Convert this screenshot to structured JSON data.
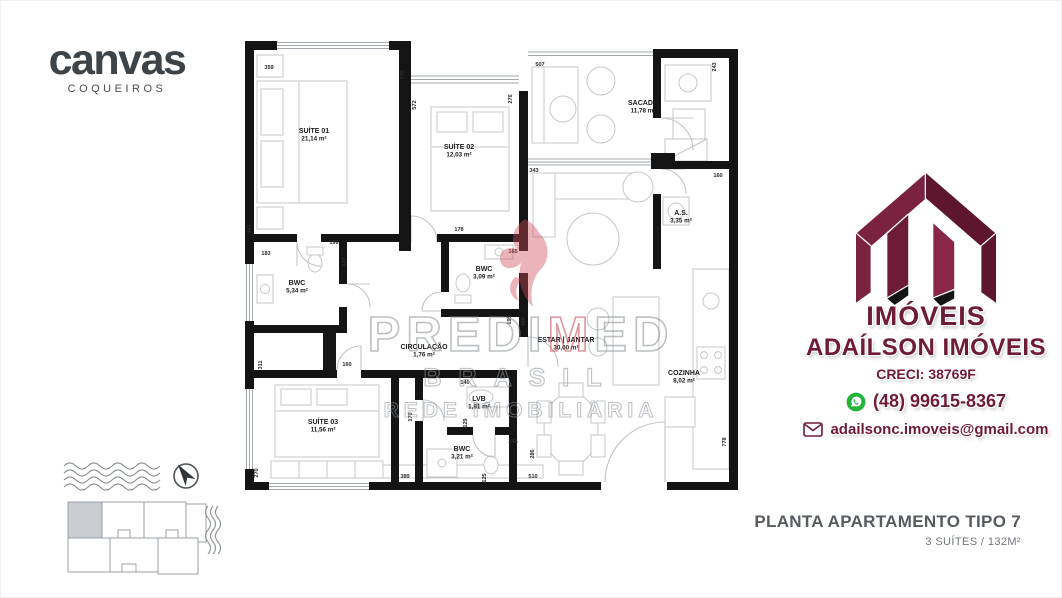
{
  "branding_left": {
    "logo": "canvas",
    "sublogo": "COQUEIROS"
  },
  "watermark": {
    "word": "PREDIMED",
    "accent_index": 5,
    "line2": "BRASIL",
    "line3": "REDE IMOBILIARIA"
  },
  "floorplan": {
    "rooms": [
      {
        "id": "suite-01",
        "name": "SUÍTE 01",
        "area": "21,14 m²",
        "x": 73,
        "y": 104
      },
      {
        "id": "suite-02",
        "name": "SUÍTE 02",
        "area": "12,03 m²",
        "x": 218,
        "y": 120
      },
      {
        "id": "sacada",
        "name": "SACADA",
        "area": "11,78 m²",
        "x": 402,
        "y": 76
      },
      {
        "id": "area-servico",
        "name": "A.S.",
        "area": "3,35 m²",
        "x": 440,
        "y": 186
      },
      {
        "id": "bwc-suite-01",
        "name": "BWC",
        "area": "5,34 m²",
        "x": 56,
        "y": 256
      },
      {
        "id": "bwc-suite-02",
        "name": "BWC",
        "area": "3,09 m²",
        "x": 243,
        "y": 242
      },
      {
        "id": "circulacao",
        "name": "CIRCULAÇÃO",
        "area": "1,76 m²",
        "x": 183,
        "y": 320
      },
      {
        "id": "estar-jantar",
        "name": "ESTAR | JANTAR",
        "area": "30,00 m²",
        "x": 325,
        "y": 313
      },
      {
        "id": "cozinha",
        "name": "COZINHA",
        "area": "8,02 m²",
        "x": 443,
        "y": 346
      },
      {
        "id": "suite-03",
        "name": "SUÍTE 03",
        "area": "11,56 m²",
        "x": 82,
        "y": 395
      },
      {
        "id": "lvb",
        "name": "LVB",
        "area": "1,81 m²",
        "x": 238,
        "y": 372
      },
      {
        "id": "bwc-suite-03",
        "name": "BWC",
        "area": "3,21 m²",
        "x": 221,
        "y": 422
      }
    ],
    "dimensions": [
      {
        "t": "359",
        "x": 28,
        "y": 40,
        "r": 0
      },
      {
        "t": "770",
        "x": 163,
        "y": 46,
        "r": 90
      },
      {
        "t": "572",
        "x": 175,
        "y": 76,
        "r": 90
      },
      {
        "t": "276",
        "x": 271,
        "y": 70,
        "r": 90
      },
      {
        "t": "507",
        "x": 299,
        "y": 37,
        "r": 0
      },
      {
        "t": "243",
        "x": 475,
        "y": 38,
        "r": 90
      },
      {
        "t": "343",
        "x": 293,
        "y": 143,
        "r": 0
      },
      {
        "t": "160",
        "x": 477,
        "y": 148,
        "r": 0
      },
      {
        "t": "443",
        "x": 10,
        "y": 200,
        "r": 90
      },
      {
        "t": "199",
        "x": 93,
        "y": 215,
        "r": 0
      },
      {
        "t": "183",
        "x": 25,
        "y": 226,
        "r": 0
      },
      {
        "t": "327",
        "x": 105,
        "y": 233,
        "r": 90
      },
      {
        "t": "178",
        "x": 218,
        "y": 202,
        "r": 0
      },
      {
        "t": "165",
        "x": 272,
        "y": 224,
        "r": 0
      },
      {
        "t": "195",
        "x": 270,
        "y": 291,
        "r": 90
      },
      {
        "t": "408",
        "x": 284,
        "y": 293,
        "r": 90
      },
      {
        "t": "311",
        "x": 21,
        "y": 336,
        "r": 90
      },
      {
        "t": "160",
        "x": 106,
        "y": 337,
        "r": 0
      },
      {
        "t": "140",
        "x": 224,
        "y": 355,
        "r": 0
      },
      {
        "t": "170",
        "x": 171,
        "y": 388,
        "r": 90
      },
      {
        "t": "129",
        "x": 226,
        "y": 394,
        "r": 90
      },
      {
        "t": "270",
        "x": 17,
        "y": 444,
        "r": 90
      },
      {
        "t": "389",
        "x": 164,
        "y": 449,
        "r": 0
      },
      {
        "t": "125",
        "x": 245,
        "y": 449,
        "r": 90
      },
      {
        "t": "246",
        "x": 272,
        "y": 414,
        "r": 0
      },
      {
        "t": "510",
        "x": 292,
        "y": 449,
        "r": 0
      },
      {
        "t": "286",
        "x": 293,
        "y": 425,
        "r": 90
      },
      {
        "t": "778",
        "x": 485,
        "y": 413,
        "r": 90
      }
    ]
  },
  "broker": {
    "brand": "IMÓVEIS",
    "name": "ADAÍLSON IMÓVEIS",
    "creci": "CRECI: 38769F",
    "phone": "(48) 99615-8367",
    "email": "adailsonc.imoveis@gmail.com",
    "colors": {
      "maroon": "#6e1b37",
      "maroon_dark": "#5b142c",
      "green": "#23b33a"
    }
  },
  "caption": {
    "title": "PLANTA APARTAMENTO TIPO 7",
    "subtitle": "3 SUÍTES / 132M²"
  }
}
